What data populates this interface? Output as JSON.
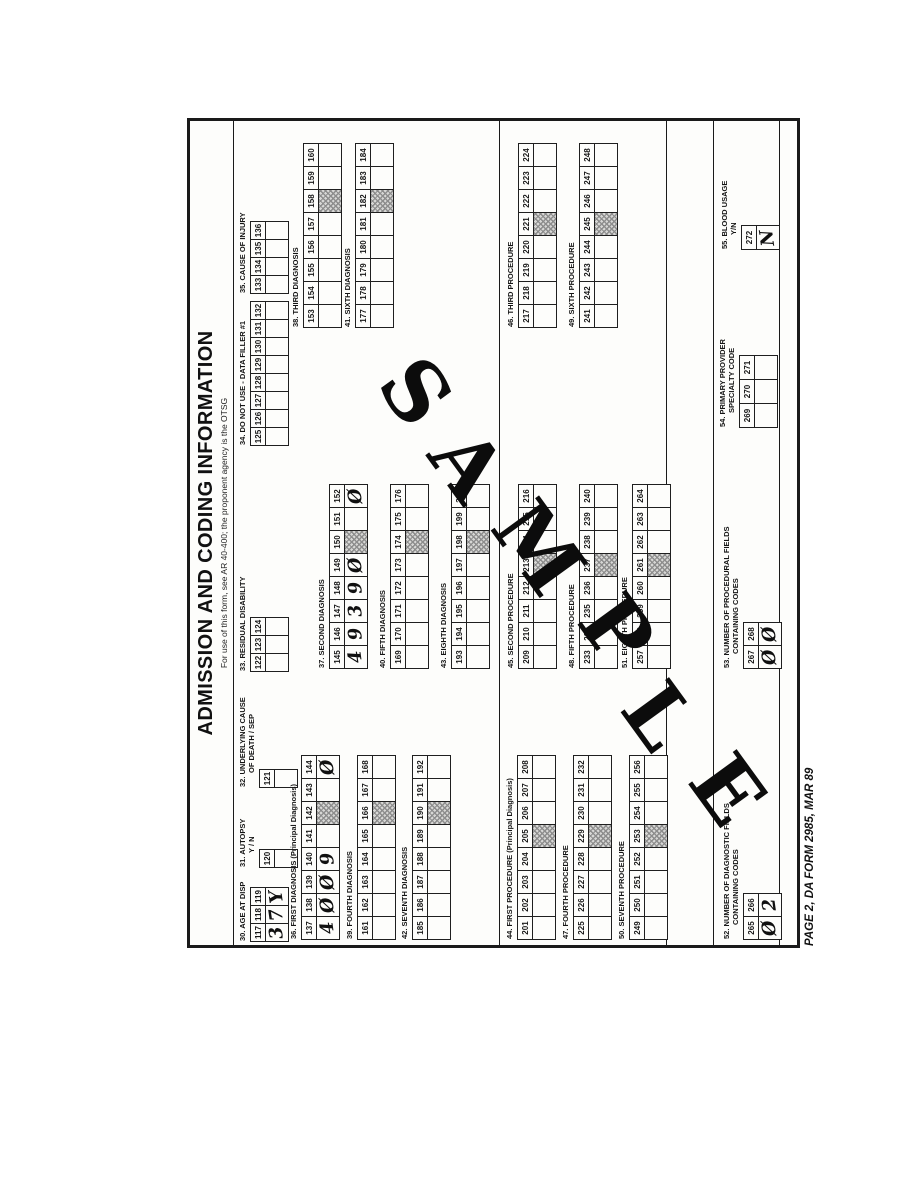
{
  "document": {
    "title": "ADMISSION AND CODING INFORMATION",
    "subtitle": "For use of this form, see AR 40-400; the proponent agency is the OTSG",
    "footer": "PAGE 2, DA FORM 2985, MAR 89",
    "watermark": "SAMPLE"
  },
  "colors": {
    "ink": "#1a1a1a",
    "paper": "#fdfdfb",
    "hatch_fill": "#d7d7d5",
    "hatch_line": "#8d8d8d"
  },
  "blocks": [
    {
      "id": "30",
      "label": "30.  AGE AT DISP",
      "cells": [
        "117",
        "118",
        "119"
      ],
      "entries": [
        "3",
        "7",
        "Y"
      ]
    },
    {
      "id": "31",
      "label": "31.  AUTOPSY",
      "label2": "Y / N",
      "cells": [
        "120"
      ],
      "entries": [
        ""
      ]
    },
    {
      "id": "32",
      "label": "32.  UNDERLYING CAUSE",
      "label2": "OF DEATH / SEP",
      "cells": [
        "121"
      ],
      "entries": [
        ""
      ]
    },
    {
      "id": "33",
      "label": "33.  RESIDUAL DISABILITY",
      "cells": [
        "122",
        "123",
        "124"
      ],
      "entries": [
        "",
        "",
        ""
      ]
    },
    {
      "id": "34",
      "label": "34.  DO NOT USE - DATA FILLER #1",
      "cells": [
        "125",
        "126",
        "127",
        "128",
        "129",
        "130",
        "131",
        "132"
      ],
      "entries": [
        "",
        "",
        "",
        "",
        "",
        "",
        "",
        ""
      ]
    },
    {
      "id": "35",
      "label": "35.  CAUSE OF INJURY",
      "cells": [
        "133",
        "134",
        "135",
        "136"
      ],
      "entries": [
        "",
        "",
        "",
        ""
      ]
    },
    {
      "id": "36",
      "label": "36.  FIRST DIAGNOSIS (Principal Diagnosis)",
      "cells": [
        "137",
        "138",
        "139",
        "140",
        "141",
        "142",
        "143",
        "144"
      ],
      "entries": [
        "4",
        "Ø",
        "Ø",
        "9",
        "",
        "",
        "",
        "Ø"
      ],
      "hatch": 5
    },
    {
      "id": "37",
      "label": "37.  SECOND DIAGNOSIS",
      "cells": [
        "145",
        "146",
        "147",
        "148",
        "149",
        "150",
        "151",
        "152"
      ],
      "entries": [
        "4",
        "9",
        "3",
        "9",
        "Ø",
        "",
        "",
        "Ø"
      ],
      "hatch": 5
    },
    {
      "id": "38",
      "label": "38.  THIRD DIAGNOSIS",
      "cells": [
        "153",
        "154",
        "155",
        "156",
        "157",
        "158",
        "159",
        "160"
      ],
      "entries": [
        "",
        "",
        "",
        "",
        "",
        "",
        "",
        ""
      ],
      "hatch": 5
    },
    {
      "id": "39",
      "label": "39.  FOURTH DIAGNOSIS",
      "cells": [
        "161",
        "162",
        "163",
        "164",
        "165",
        "166",
        "167",
        "168"
      ],
      "entries": [
        "",
        "",
        "",
        "",
        "",
        "",
        "",
        ""
      ],
      "hatch": 5
    },
    {
      "id": "40",
      "label": "40.  FIFTH DIAGNOSIS",
      "cells": [
        "169",
        "170",
        "171",
        "172",
        "173",
        "174",
        "175",
        "176"
      ],
      "entries": [
        "",
        "",
        "",
        "",
        "",
        "",
        "",
        ""
      ],
      "hatch": 5
    },
    {
      "id": "41",
      "label": "41.  SIXTH DIAGNOSIS",
      "cells": [
        "177",
        "178",
        "179",
        "180",
        "181",
        "182",
        "183",
        "184"
      ],
      "entries": [
        "",
        "",
        "",
        "",
        "",
        "",
        "",
        ""
      ],
      "hatch": 5
    },
    {
      "id": "42",
      "label": "42.  SEVENTH DIAGNOSIS",
      "cells": [
        "185",
        "186",
        "187",
        "188",
        "189",
        "190",
        "191",
        "192"
      ],
      "entries": [
        "",
        "",
        "",
        "",
        "",
        "",
        "",
        ""
      ],
      "hatch": 5
    },
    {
      "id": "43",
      "label": "43.  EIGHTH DIAGNOSIS",
      "cells": [
        "193",
        "194",
        "195",
        "196",
        "197",
        "198",
        "199",
        "200"
      ],
      "entries": [
        "",
        "",
        "",
        "",
        "",
        "",
        "",
        ""
      ],
      "hatch": 5
    },
    {
      "id": "44",
      "label": "44.  FIRST PROCEDURE (Principal Diagnosis)",
      "cells": [
        "201",
        "202",
        "203",
        "204",
        "205",
        "206",
        "207",
        "208"
      ],
      "entries": [
        "",
        "",
        "",
        "",
        "",
        "",
        "",
        ""
      ],
      "hatch": 4
    },
    {
      "id": "45",
      "label": "45.  SECOND PROCEDURE",
      "cells": [
        "209",
        "210",
        "211",
        "212",
        "213",
        "214",
        "215",
        "216"
      ],
      "entries": [
        "",
        "",
        "",
        "",
        "",
        "",
        "",
        ""
      ],
      "hatch": 4
    },
    {
      "id": "46",
      "label": "46.  THIRD PROCEDURE",
      "cells": [
        "217",
        "218",
        "219",
        "220",
        "221",
        "222",
        "223",
        "224"
      ],
      "entries": [
        "",
        "",
        "",
        "",
        "",
        "",
        "",
        ""
      ],
      "hatch": 4
    },
    {
      "id": "47",
      "label": "47.  FOURTH PROCEDURE",
      "cells": [
        "225",
        "226",
        "227",
        "228",
        "229",
        "230",
        "231",
        "232"
      ],
      "entries": [
        "",
        "",
        "",
        "",
        "",
        "",
        "",
        ""
      ],
      "hatch": 4
    },
    {
      "id": "48",
      "label": "48.  FIFTH PROCEDURE",
      "cells": [
        "233",
        "234",
        "235",
        "236",
        "237",
        "238",
        "239",
        "240"
      ],
      "entries": [
        "",
        "",
        "",
        "",
        "",
        "",
        "",
        ""
      ],
      "hatch": 4
    },
    {
      "id": "49",
      "label": "49.  SIXTH PROCEDURE",
      "cells": [
        "241",
        "242",
        "243",
        "244",
        "245",
        "246",
        "247",
        "248"
      ],
      "entries": [
        "",
        "",
        "",
        "",
        "",
        "",
        "",
        ""
      ],
      "hatch": 4
    },
    {
      "id": "50",
      "label": "50.  SEVENTH PROCEDURE",
      "cells": [
        "249",
        "250",
        "251",
        "252",
        "253",
        "254",
        "255",
        "256"
      ],
      "entries": [
        "",
        "",
        "",
        "",
        "",
        "",
        "",
        ""
      ],
      "hatch": 4
    },
    {
      "id": "51",
      "label": "51.  EIGHTH PROCEDURE",
      "cells": [
        "257",
        "258",
        "259",
        "260",
        "261",
        "262",
        "263",
        "264"
      ],
      "entries": [
        "",
        "",
        "",
        "",
        "",
        "",
        "",
        ""
      ],
      "hatch": 4
    },
    {
      "id": "52",
      "label": "52.  NUMBER OF DIAGNOSTIC FIELDS",
      "label2": "CONTAINING CODES",
      "cells": [
        "265",
        "266"
      ],
      "entries": [
        "Ø",
        "2"
      ]
    },
    {
      "id": "53",
      "label": "53.  NUMBER OF PROCEDURAL FIELDS",
      "label2": "CONTAINING CODES",
      "cells": [
        "267",
        "268"
      ],
      "entries": [
        "Ø",
        "Ø"
      ]
    },
    {
      "id": "54",
      "label": "54.  PRIMARY PROVIDER",
      "label2": "SPECIALTY CODE",
      "cells": [
        "269",
        "270",
        "271"
      ],
      "entries": [
        "",
        "",
        ""
      ]
    },
    {
      "id": "55",
      "label": "55.  BLOOD USAGE",
      "label2": "Y/N",
      "cells": [
        "272"
      ],
      "entries": [
        "N"
      ]
    }
  ]
}
